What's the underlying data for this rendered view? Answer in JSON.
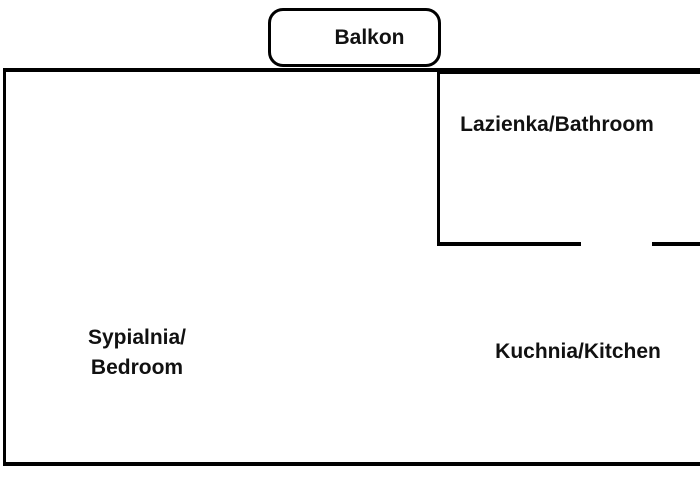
{
  "floor_plan": {
    "balcony": {
      "label": "Balkon"
    },
    "bathroom": {
      "label": "Lazienka/Bathroom"
    },
    "bedroom": {
      "label": "Sypialnia/\nBedroom"
    },
    "kitchen": {
      "label": "Kuchnia/Kitchen"
    },
    "colors": {
      "wall": "#000000",
      "text": "#111111",
      "background": "#ffffff"
    }
  }
}
